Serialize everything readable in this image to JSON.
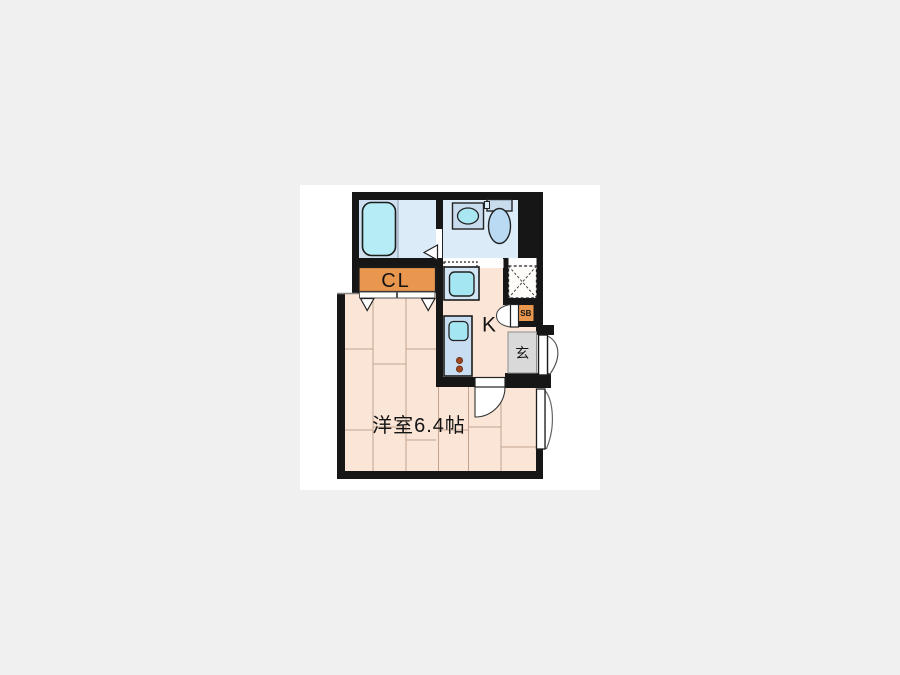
{
  "floorplan": {
    "type": "apartment-floor-plan",
    "rooms": {
      "western_room": {
        "label": "洋室6.4帖"
      },
      "kitchen": {
        "label": "K"
      },
      "closet": {
        "label": "CL"
      },
      "shoe_box": {
        "label": "SB"
      },
      "entrance": {
        "label": "玄"
      }
    },
    "fixtures": [
      "bathtub",
      "washbasin",
      "toilet",
      "kitchen-sink",
      "stove-burners",
      "washing-machine-space",
      "entrance-door",
      "balcony-door",
      "room-door",
      "closet-folding-doors"
    ],
    "colors": {
      "page_background": "#f0f0f0",
      "canvas_background": "#ffffff",
      "wall": "#161616",
      "closet_orange": "#e9964e",
      "floor_peach": "#fbe5d6",
      "wet_room_blue": "#dcebf8",
      "bath_room_blue": "#cfe1f0",
      "fixture_cyan": "#a5e6f3",
      "bathtub_cyan": "#b5ecf6",
      "counter_blue": "#c8ddf1",
      "basin_blue": "#c8dcee",
      "entrance_gray": "#d9d9d9",
      "burner_brown": "#9c4722"
    }
  }
}
